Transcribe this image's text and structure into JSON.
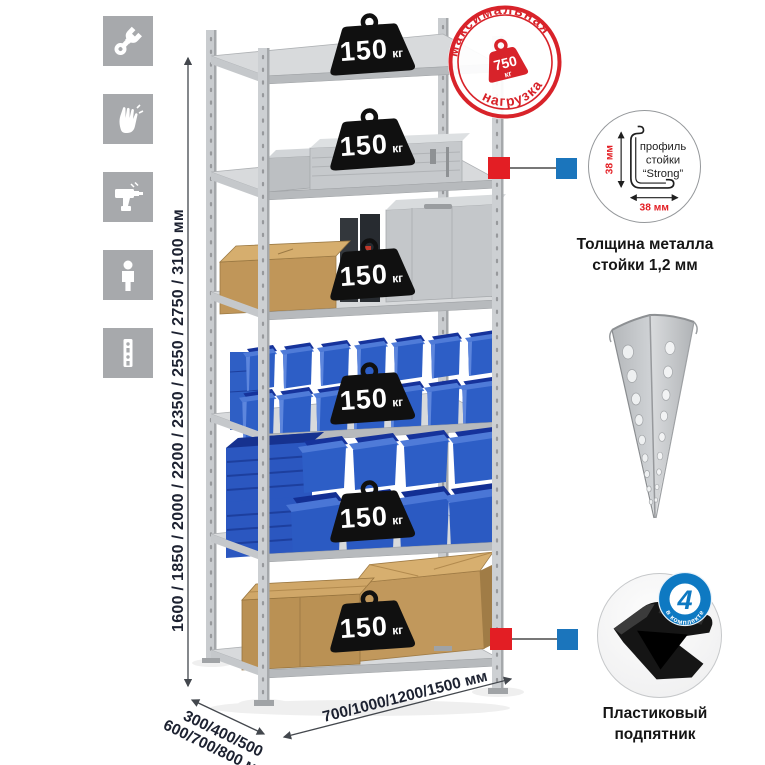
{
  "canvas": {
    "background": "#ffffff"
  },
  "legend_icons": [
    {
      "name": "wrench-icon"
    },
    {
      "name": "gloves-icon"
    },
    {
      "name": "drill-icon"
    },
    {
      "name": "person-icon"
    },
    {
      "name": "rack-post-icon"
    }
  ],
  "dimensions": {
    "height": "1600 / 1850 / 2000 / 2200 / 2350 / 2550 / 2750 / 3100 мм",
    "depth1": "300/400/500",
    "depth2": "600/700/800 мм",
    "width": "700/1000/1200/1500 мм"
  },
  "stamp": {
    "top": "максимальная",
    "bottom": "нагрузка",
    "value": "750",
    "unit": "кг"
  },
  "shelves": [
    {
      "load": "150",
      "unit": "кг"
    },
    {
      "load": "150",
      "unit": "кг"
    },
    {
      "load": "150",
      "unit": "кг"
    },
    {
      "load": "150",
      "unit": "кг"
    },
    {
      "load": "150",
      "unit": "кг"
    },
    {
      "load": "150",
      "unit": "кг"
    }
  ],
  "profile": {
    "dim_vertical": "38 мм",
    "dim_horizontal": "38 мм",
    "line1": "профиль",
    "line2": "стойки",
    "line3": "“Strong”",
    "caption1": "Толщина металла",
    "caption2": "стойки 1,2 мм"
  },
  "foot": {
    "badge_value": "4",
    "badge_text": "в комплекте",
    "caption1": "Пластиковый",
    "caption2": "подпятник"
  },
  "colors": {
    "stamp_red": "#d8232a",
    "marker_red": "#e31e24",
    "marker_blue": "#1b75bc",
    "badge_blue": "#0e79c2",
    "bin_blue": "#2d5ec6",
    "metal_gray": "#c9cccf",
    "icon_gray": "#a7a9ac",
    "cardboard": "#c49a5f",
    "weight_black": "#101010",
    "dim_text": "#1c2130"
  }
}
